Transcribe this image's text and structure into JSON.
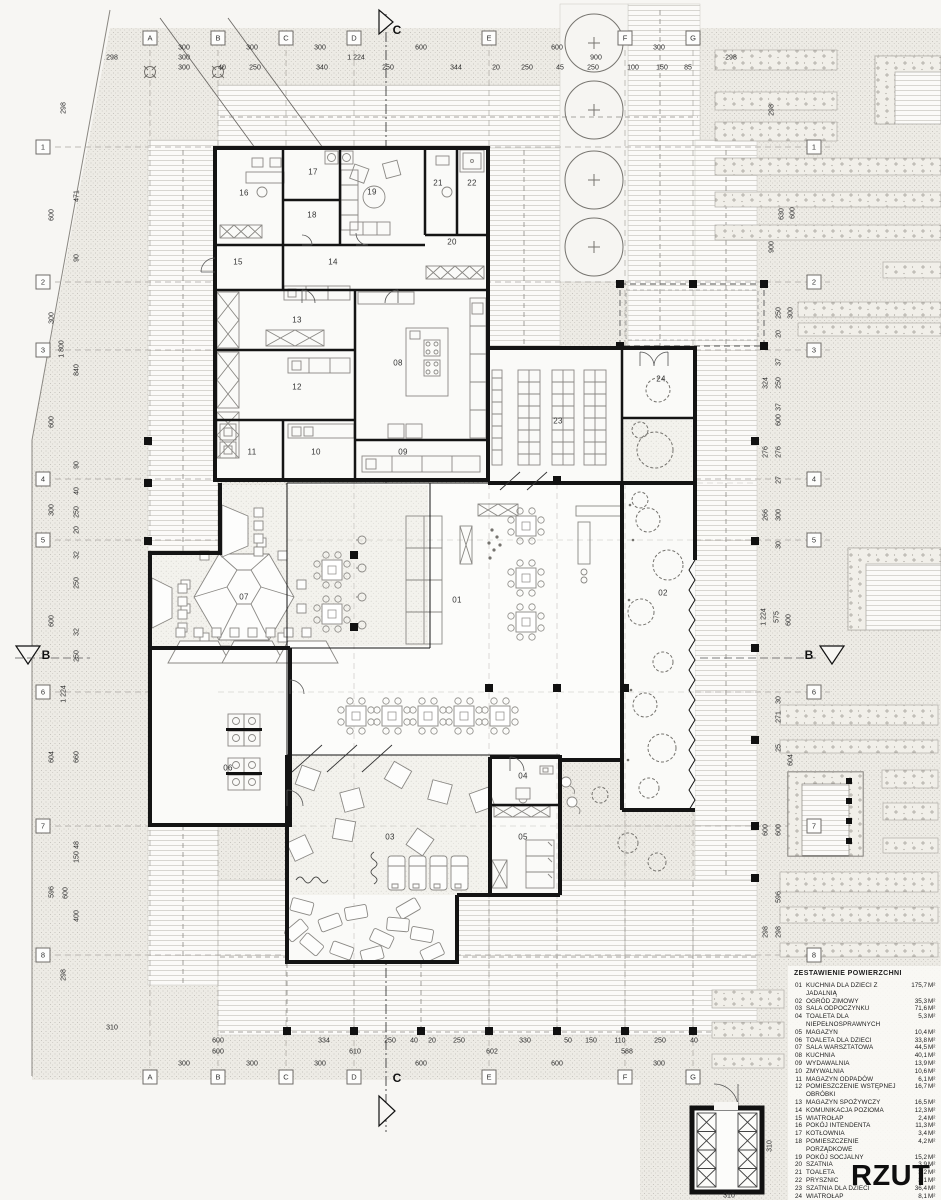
{
  "sheet": {
    "title": "RZUT"
  },
  "legend": {
    "title": "ZESTAWIENIE POWIERZCHNI",
    "unit": "M²",
    "items": [
      {
        "no": "01",
        "name": "KUCHNIA DLA DZIECI Z JADALNIĄ",
        "area": "175,7"
      },
      {
        "no": "02",
        "name": "OGRÓD ZIMOWY",
        "area": "35,3"
      },
      {
        "no": "03",
        "name": "SALA ODPOCZYNKU",
        "area": "71,6"
      },
      {
        "no": "04",
        "name": "TOALETA DLA NIEPEŁNOSPRAWNYCH",
        "area": "5,3"
      },
      {
        "no": "05",
        "name": "MAGAZYN",
        "area": "10,4"
      },
      {
        "no": "06",
        "name": "TOALETA DLA DZIECI",
        "area": "33,8"
      },
      {
        "no": "07",
        "name": "SALA WARSZTATOWA",
        "area": "44,5"
      },
      {
        "no": "08",
        "name": "KUCHNIA",
        "area": "40,1"
      },
      {
        "no": "09",
        "name": "WYDAWALNIA",
        "area": "13,9"
      },
      {
        "no": "10",
        "name": "ZMYWALNIA",
        "area": "10,6"
      },
      {
        "no": "11",
        "name": "MAGAZYN ODPADÓW",
        "area": "6,1"
      },
      {
        "no": "12",
        "name": "POMIESZCZENIE WSTĘPNEJ OBRÓBKI",
        "area": "16,7"
      },
      {
        "no": "13",
        "name": "MAGAZYN SPOŻYWCZY",
        "area": "16,5"
      },
      {
        "no": "14",
        "name": "KOMUNIKACJA POZIOMA",
        "area": "12,3"
      },
      {
        "no": "15",
        "name": "WIATROŁAP",
        "area": "2,4"
      },
      {
        "no": "16",
        "name": "POKÓJ INTENDENTA",
        "area": "11,3"
      },
      {
        "no": "17",
        "name": "KOTŁOWNIA",
        "area": "3,4"
      },
      {
        "no": "18",
        "name": "POMIESZCZENIE PORZĄDKOWE",
        "area": "4,2"
      },
      {
        "no": "19",
        "name": "POKÓJ SOCJALNY",
        "area": "15,2"
      },
      {
        "no": "20",
        "name": "SZATNIA",
        "area": "3,9"
      },
      {
        "no": "21",
        "name": "TOALETA",
        "area": "3,2"
      },
      {
        "no": "22",
        "name": "PRYSZNIC",
        "area": "3,1"
      },
      {
        "no": "23",
        "name": "SZATNIA DLA DZIECI",
        "area": "36,4"
      },
      {
        "no": "24",
        "name": "WIATROŁAP",
        "area": "8,1"
      }
    ],
    "suma_label": "SUMA",
    "suma_value": "584,0"
  },
  "grid_bubbles": [
    {
      "t": "A",
      "x": 150,
      "y": 38
    },
    {
      "t": "B",
      "x": 218,
      "y": 38
    },
    {
      "t": "C",
      "x": 286,
      "y": 38
    },
    {
      "t": "D",
      "x": 354,
      "y": 38
    },
    {
      "t": "E",
      "x": 489,
      "y": 38
    },
    {
      "t": "F",
      "x": 625,
      "y": 38
    },
    {
      "t": "G",
      "x": 693,
      "y": 38
    },
    {
      "t": "A",
      "x": 150,
      "y": 1077
    },
    {
      "t": "B",
      "x": 218,
      "y": 1077
    },
    {
      "t": "C",
      "x": 286,
      "y": 1077
    },
    {
      "t": "D",
      "x": 354,
      "y": 1077
    },
    {
      "t": "E",
      "x": 489,
      "y": 1077
    },
    {
      "t": "F",
      "x": 625,
      "y": 1077
    },
    {
      "t": "G",
      "x": 693,
      "y": 1077
    },
    {
      "t": "1",
      "x": 43,
      "y": 147
    },
    {
      "t": "2",
      "x": 43,
      "y": 282
    },
    {
      "t": "3",
      "x": 43,
      "y": 350
    },
    {
      "t": "4",
      "x": 43,
      "y": 479
    },
    {
      "t": "5",
      "x": 43,
      "y": 540
    },
    {
      "t": "6",
      "x": 43,
      "y": 692
    },
    {
      "t": "7",
      "x": 43,
      "y": 826
    },
    {
      "t": "8",
      "x": 43,
      "y": 955
    },
    {
      "t": "1",
      "x": 814,
      "y": 147
    },
    {
      "t": "2",
      "x": 814,
      "y": 282
    },
    {
      "t": "3",
      "x": 814,
      "y": 350
    },
    {
      "t": "4",
      "x": 814,
      "y": 479
    },
    {
      "t": "5",
      "x": 814,
      "y": 540
    },
    {
      "t": "6",
      "x": 814,
      "y": 692
    },
    {
      "t": "7",
      "x": 814,
      "y": 826
    },
    {
      "t": "8",
      "x": 814,
      "y": 955
    }
  ],
  "sections": [
    {
      "t": "C",
      "x": 397,
      "y": 30
    },
    {
      "t": "C",
      "x": 397,
      "y": 1078
    },
    {
      "t": "B",
      "x": 46,
      "y": 655
    },
    {
      "t": "B",
      "x": 809,
      "y": 655
    }
  ],
  "rooms": [
    {
      "no": "01",
      "x": 457,
      "y": 600
    },
    {
      "no": "02",
      "x": 663,
      "y": 593
    },
    {
      "no": "03",
      "x": 390,
      "y": 837
    },
    {
      "no": "04",
      "x": 523,
      "y": 776
    },
    {
      "no": "05",
      "x": 523,
      "y": 837
    },
    {
      "no": "06",
      "x": 228,
      "y": 768
    },
    {
      "no": "07",
      "x": 244,
      "y": 597
    },
    {
      "no": "08",
      "x": 398,
      "y": 363
    },
    {
      "no": "09",
      "x": 403,
      "y": 452
    },
    {
      "no": "10",
      "x": 316,
      "y": 452
    },
    {
      "no": "11",
      "x": 252,
      "y": 452
    },
    {
      "no": "12",
      "x": 297,
      "y": 387
    },
    {
      "no": "13",
      "x": 297,
      "y": 320
    },
    {
      "no": "14",
      "x": 333,
      "y": 262
    },
    {
      "no": "15",
      "x": 238,
      "y": 262
    },
    {
      "no": "16",
      "x": 244,
      "y": 193
    },
    {
      "no": "17",
      "x": 313,
      "y": 172
    },
    {
      "no": "18",
      "x": 312,
      "y": 215
    },
    {
      "no": "19",
      "x": 372,
      "y": 192
    },
    {
      "no": "20",
      "x": 452,
      "y": 242
    },
    {
      "no": "21",
      "x": 438,
      "y": 183
    },
    {
      "no": "22",
      "x": 472,
      "y": 183
    },
    {
      "no": "23",
      "x": 558,
      "y": 421
    },
    {
      "no": "24",
      "x": 661,
      "y": 379
    }
  ],
  "dims": [
    {
      "t": "300",
      "x": 184,
      "y": 48
    },
    {
      "t": "300",
      "x": 252,
      "y": 48
    },
    {
      "t": "300",
      "x": 320,
      "y": 48
    },
    {
      "t": "600",
      "x": 421,
      "y": 48
    },
    {
      "t": "600",
      "x": 557,
      "y": 48
    },
    {
      "t": "300",
      "x": 659,
      "y": 48
    },
    {
      "t": "298",
      "x": 112,
      "y": 58
    },
    {
      "t": "300",
      "x": 184,
      "y": 58
    },
    {
      "t": "1 224",
      "x": 356,
      "y": 58
    },
    {
      "t": "900",
      "x": 596,
      "y": 58
    },
    {
      "t": "298",
      "x": 731,
      "y": 58
    },
    {
      "t": "300",
      "x": 184,
      "y": 68
    },
    {
      "t": "40",
      "x": 222,
      "y": 68
    },
    {
      "t": "250",
      "x": 255,
      "y": 68
    },
    {
      "t": "340",
      "x": 322,
      "y": 68
    },
    {
      "t": "250",
      "x": 388,
      "y": 68
    },
    {
      "t": "344",
      "x": 456,
      "y": 68
    },
    {
      "t": "20",
      "x": 496,
      "y": 68
    },
    {
      "t": "250",
      "x": 527,
      "y": 68
    },
    {
      "t": "45",
      "x": 560,
      "y": 68
    },
    {
      "t": "250",
      "x": 593,
      "y": 68
    },
    {
      "t": "100",
      "x": 633,
      "y": 68
    },
    {
      "t": "150",
      "x": 662,
      "y": 68
    },
    {
      "t": "85",
      "x": 688,
      "y": 68
    },
    {
      "t": "298",
      "x": 64,
      "y": 108,
      "r": 1
    },
    {
      "t": "600",
      "x": 52,
      "y": 215,
      "r": 1
    },
    {
      "t": "471",
      "x": 77,
      "y": 196,
      "r": 1
    },
    {
      "t": "90",
      "x": 77,
      "y": 258,
      "r": 1
    },
    {
      "t": "300",
      "x": 52,
      "y": 318,
      "r": 1
    },
    {
      "t": "1 800",
      "x": 62,
      "y": 349,
      "r": 1
    },
    {
      "t": "840",
      "x": 77,
      "y": 370,
      "r": 1
    },
    {
      "t": "600",
      "x": 52,
      "y": 422,
      "r": 1
    },
    {
      "t": "90",
      "x": 77,
      "y": 465,
      "r": 1
    },
    {
      "t": "40",
      "x": 77,
      "y": 491,
      "r": 1
    },
    {
      "t": "250",
      "x": 77,
      "y": 512,
      "r": 1
    },
    {
      "t": "20",
      "x": 77,
      "y": 530,
      "r": 1
    },
    {
      "t": "300",
      "x": 52,
      "y": 510,
      "r": 1
    },
    {
      "t": "32",
      "x": 77,
      "y": 555,
      "r": 1
    },
    {
      "t": "250",
      "x": 77,
      "y": 583,
      "r": 1
    },
    {
      "t": "600",
      "x": 52,
      "y": 621,
      "r": 1
    },
    {
      "t": "32",
      "x": 77,
      "y": 632,
      "r": 1
    },
    {
      "t": "250",
      "x": 77,
      "y": 656,
      "r": 1
    },
    {
      "t": "1 224",
      "x": 64,
      "y": 694,
      "r": 1
    },
    {
      "t": "604",
      "x": 52,
      "y": 757,
      "r": 1
    },
    {
      "t": "660",
      "x": 77,
      "y": 757,
      "r": 1
    },
    {
      "t": "48",
      "x": 77,
      "y": 845,
      "r": 1
    },
    {
      "t": "150",
      "x": 77,
      "y": 857,
      "r": 1
    },
    {
      "t": "596",
      "x": 52,
      "y": 892,
      "r": 1
    },
    {
      "t": "600",
      "x": 66,
      "y": 893,
      "r": 1
    },
    {
      "t": "400",
      "x": 77,
      "y": 916,
      "r": 1
    },
    {
      "t": "298",
      "x": 64,
      "y": 975,
      "r": 1
    },
    {
      "t": "310",
      "x": 112,
      "y": 1028
    },
    {
      "t": "298",
      "x": 772,
      "y": 110,
      "r": 1
    },
    {
      "t": "630",
      "x": 782,
      "y": 214,
      "r": 1
    },
    {
      "t": "600",
      "x": 793,
      "y": 213,
      "r": 1
    },
    {
      "t": "900",
      "x": 772,
      "y": 247,
      "r": 1
    },
    {
      "t": "250",
      "x": 779,
      "y": 313,
      "r": 1
    },
    {
      "t": "300",
      "x": 791,
      "y": 313,
      "r": 1
    },
    {
      "t": "20",
      "x": 779,
      "y": 334,
      "r": 1
    },
    {
      "t": "37",
      "x": 779,
      "y": 362,
      "r": 1
    },
    {
      "t": "324",
      "x": 766,
      "y": 383,
      "r": 1
    },
    {
      "t": "250",
      "x": 779,
      "y": 383,
      "r": 1
    },
    {
      "t": "37",
      "x": 779,
      "y": 407,
      "r": 1
    },
    {
      "t": "600",
      "x": 779,
      "y": 420,
      "r": 1
    },
    {
      "t": "276",
      "x": 766,
      "y": 452,
      "r": 1
    },
    {
      "t": "276",
      "x": 779,
      "y": 452,
      "r": 1
    },
    {
      "t": "27",
      "x": 779,
      "y": 480,
      "r": 1
    },
    {
      "t": "266",
      "x": 766,
      "y": 515,
      "r": 1
    },
    {
      "t": "300",
      "x": 779,
      "y": 515,
      "r": 1
    },
    {
      "t": "30",
      "x": 779,
      "y": 545,
      "r": 1
    },
    {
      "t": "1 224",
      "x": 764,
      "y": 617,
      "r": 1
    },
    {
      "t": "575",
      "x": 777,
      "y": 617,
      "r": 1
    },
    {
      "t": "600",
      "x": 789,
      "y": 620,
      "r": 1
    },
    {
      "t": "30",
      "x": 779,
      "y": 700,
      "r": 1
    },
    {
      "t": "271",
      "x": 779,
      "y": 717,
      "r": 1
    },
    {
      "t": "25",
      "x": 779,
      "y": 748,
      "r": 1
    },
    {
      "t": "604",
      "x": 791,
      "y": 760,
      "r": 1
    },
    {
      "t": "600",
      "x": 766,
      "y": 830,
      "r": 1
    },
    {
      "t": "600",
      "x": 779,
      "y": 830,
      "r": 1
    },
    {
      "t": "596",
      "x": 779,
      "y": 897,
      "r": 1
    },
    {
      "t": "298",
      "x": 766,
      "y": 932,
      "r": 1
    },
    {
      "t": "298",
      "x": 779,
      "y": 932,
      "r": 1
    },
    {
      "t": "310",
      "x": 770,
      "y": 1146,
      "r": 1
    },
    {
      "t": "600",
      "x": 218,
      "y": 1041
    },
    {
      "t": "334",
      "x": 324,
      "y": 1041
    },
    {
      "t": "250",
      "x": 390,
      "y": 1041
    },
    {
      "t": "40",
      "x": 414,
      "y": 1041
    },
    {
      "t": "20",
      "x": 432,
      "y": 1041
    },
    {
      "t": "250",
      "x": 459,
      "y": 1041
    },
    {
      "t": "330",
      "x": 525,
      "y": 1041
    },
    {
      "t": "50",
      "x": 568,
      "y": 1041
    },
    {
      "t": "150",
      "x": 591,
      "y": 1041
    },
    {
      "t": "110",
      "x": 620,
      "y": 1041
    },
    {
      "t": "250",
      "x": 660,
      "y": 1041
    },
    {
      "t": "40",
      "x": 694,
      "y": 1041
    },
    {
      "t": "600",
      "x": 218,
      "y": 1052
    },
    {
      "t": "610",
      "x": 355,
      "y": 1052
    },
    {
      "t": "602",
      "x": 492,
      "y": 1052
    },
    {
      "t": "588",
      "x": 627,
      "y": 1052
    },
    {
      "t": "300",
      "x": 184,
      "y": 1064
    },
    {
      "t": "300",
      "x": 252,
      "y": 1064
    },
    {
      "t": "300",
      "x": 320,
      "y": 1064
    },
    {
      "t": "600",
      "x": 421,
      "y": 1064
    },
    {
      "t": "600",
      "x": 557,
      "y": 1064
    },
    {
      "t": "300",
      "x": 659,
      "y": 1064
    },
    {
      "t": "310",
      "x": 729,
      "y": 1196
    }
  ]
}
